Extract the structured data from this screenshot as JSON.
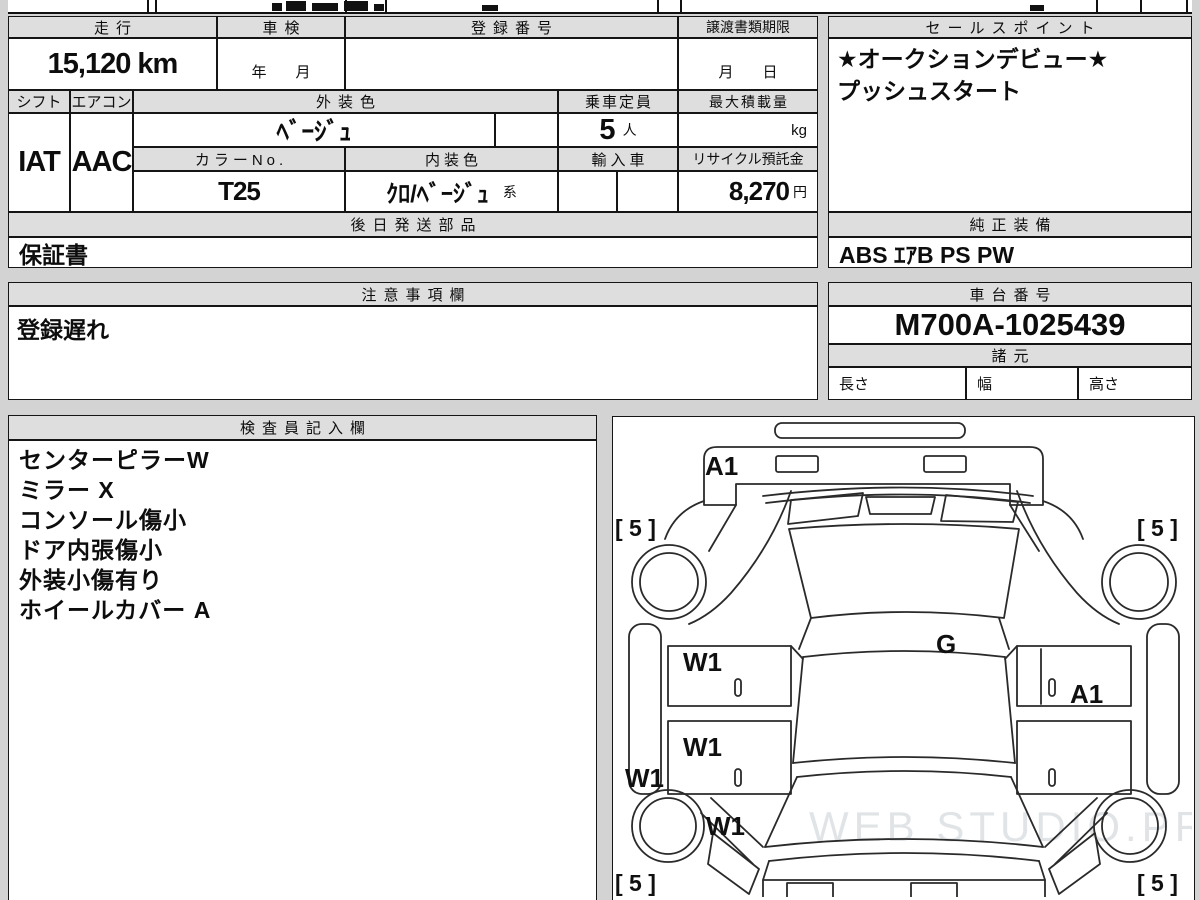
{
  "vehicle_table": {
    "mileage_label": "走行",
    "mileage_value": "15,120 km",
    "shaken_label": "車検",
    "shaken_value": "年　月",
    "registration_label": "登録番号",
    "transfer_docs_label": "譲渡書類期限",
    "transfer_docs_value": "月　日",
    "shift_label": "シフト",
    "shift_value": "IAT",
    "aircon_label": "エアコン",
    "aircon_value": "AAC",
    "exterior_color_label": "外装色",
    "exterior_color_value": "ﾍﾞｰｼﾞｭ",
    "capacity_label": "乗車定員",
    "capacity_value": "5",
    "capacity_unit": "人",
    "max_load_label": "最大積載量",
    "max_load_unit": "kg",
    "color_no_label": "カラーNo.",
    "color_no_value": "T25",
    "interior_color_label": "内装色",
    "interior_color_value": "ｸﾛ/ﾍﾞｰｼﾞｭ",
    "interior_color_suffix": "系",
    "import_label": "輸入車",
    "recycle_label": "リサイクル預託金",
    "recycle_value": "8,270",
    "recycle_unit": "円",
    "later_parts_label": "後日発送部品",
    "later_parts_value": "保証書"
  },
  "sales_point": {
    "title": "セールスポイント",
    "line1": "★オークションデビュー★",
    "line2": "プッシュスタート"
  },
  "equipment": {
    "title": "純正装備",
    "value": "ABS ｴｱB PS PW"
  },
  "notes": {
    "title": "注意事項欄",
    "value": "登録遅れ"
  },
  "chassis": {
    "title": "車台番号",
    "value": "M700A-1025439"
  },
  "specs": {
    "title": "諸元",
    "length_label": "長さ",
    "width_label": "幅",
    "height_label": "高さ"
  },
  "inspector": {
    "title": "検査員記入欄",
    "lines": [
      "センターピラーW",
      "ミラー X",
      "コンソール傷小",
      "ドア内張傷小",
      "外装小傷有り",
      "ホイールカバー A"
    ]
  },
  "diagram": {
    "labels": {
      "front_panel": "A1",
      "roof": "G",
      "front_door": "W1",
      "rear_door": "W1",
      "side_sill": "W1",
      "rear_wheel": "W1",
      "right_door": "A1"
    },
    "tire_marks": {
      "front_left": "[ 5 ]",
      "front_right": "[ 5 ]",
      "rear_left": "[ 5 ]",
      "rear_right": "[ 5 ]"
    },
    "watermark": "WEB STUDIO.PRO"
  },
  "colors": {
    "background": "#d3d3d3",
    "header_fill": "#dedede",
    "border": "#151515"
  }
}
